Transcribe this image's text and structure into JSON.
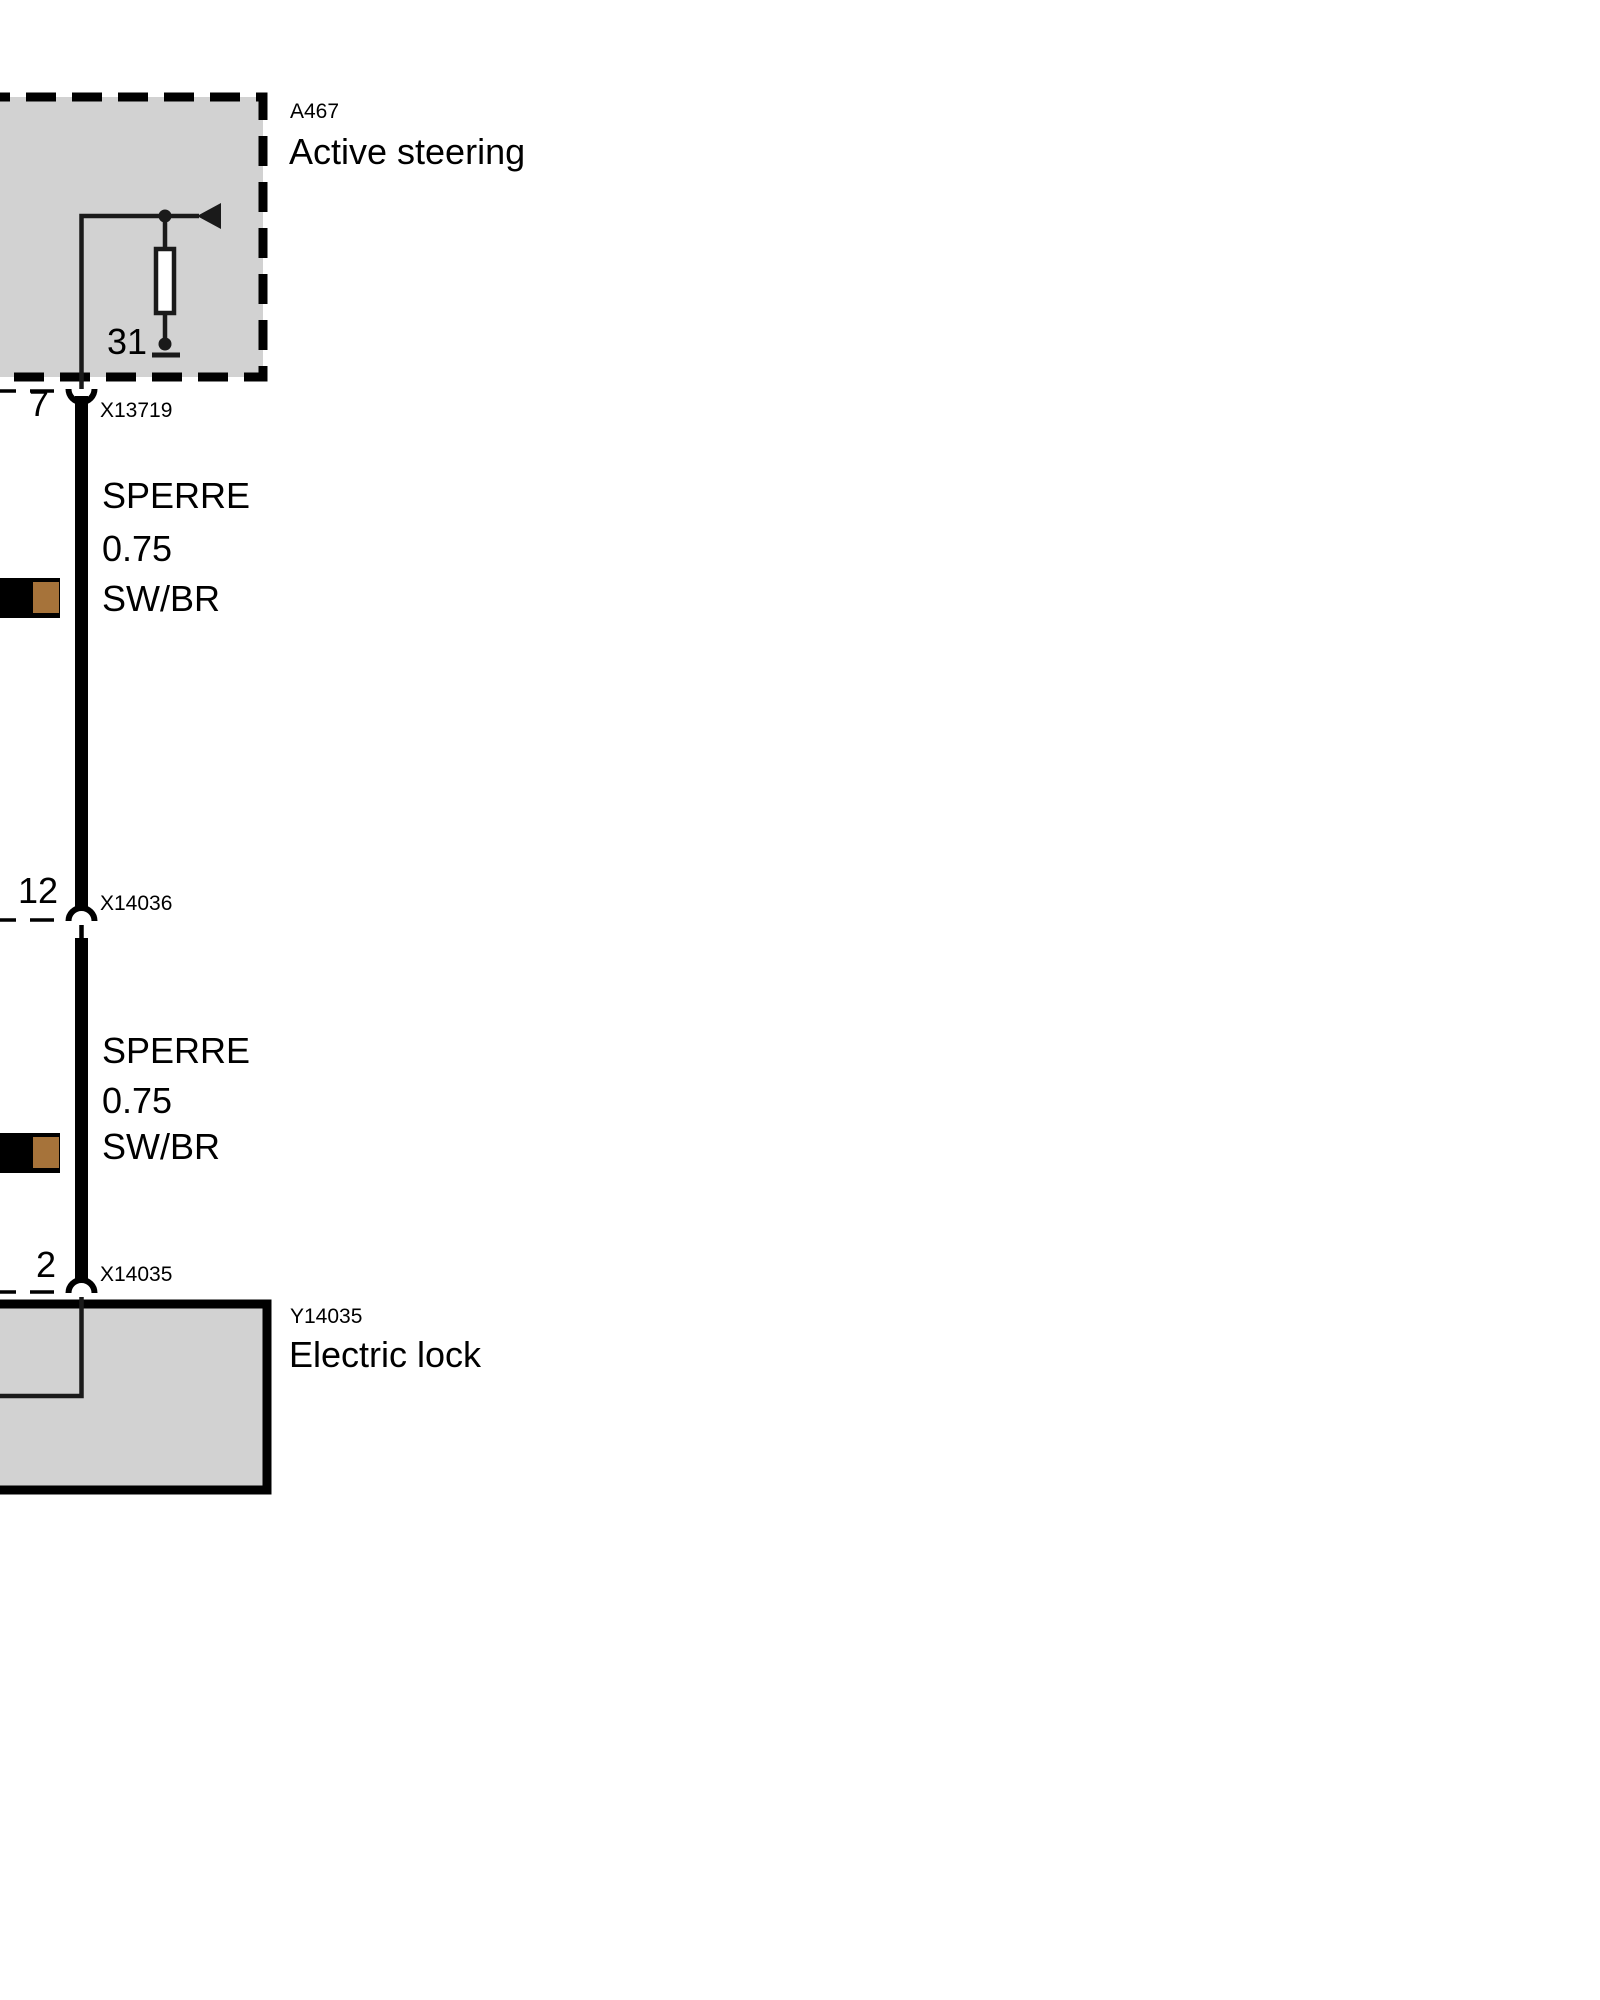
{
  "module_top": {
    "code": "A467",
    "name": "Active steering",
    "ground_pin_label": "31"
  },
  "connector_top": {
    "pin": "7",
    "code": "X13719"
  },
  "wire_segment_1": {
    "name": "SPERRE",
    "gauge": "0.75",
    "color_code": "SW/BR"
  },
  "connector_mid": {
    "pin": "12",
    "code": "X14036"
  },
  "wire_segment_2": {
    "name": "SPERRE",
    "gauge": "0.75",
    "color_code": "SW/BR"
  },
  "connector_bottom": {
    "pin": "2",
    "code": "X14035"
  },
  "module_bottom": {
    "code": "Y14035",
    "name": "Electric lock"
  },
  "colors": {
    "background": "#ffffff",
    "module_fill": "#d2d2d2",
    "line": "#000000",
    "resistor_fill": "#ffffff",
    "wire_swatch_black": "#000000",
    "wire_swatch_brown": "#a6733a"
  }
}
